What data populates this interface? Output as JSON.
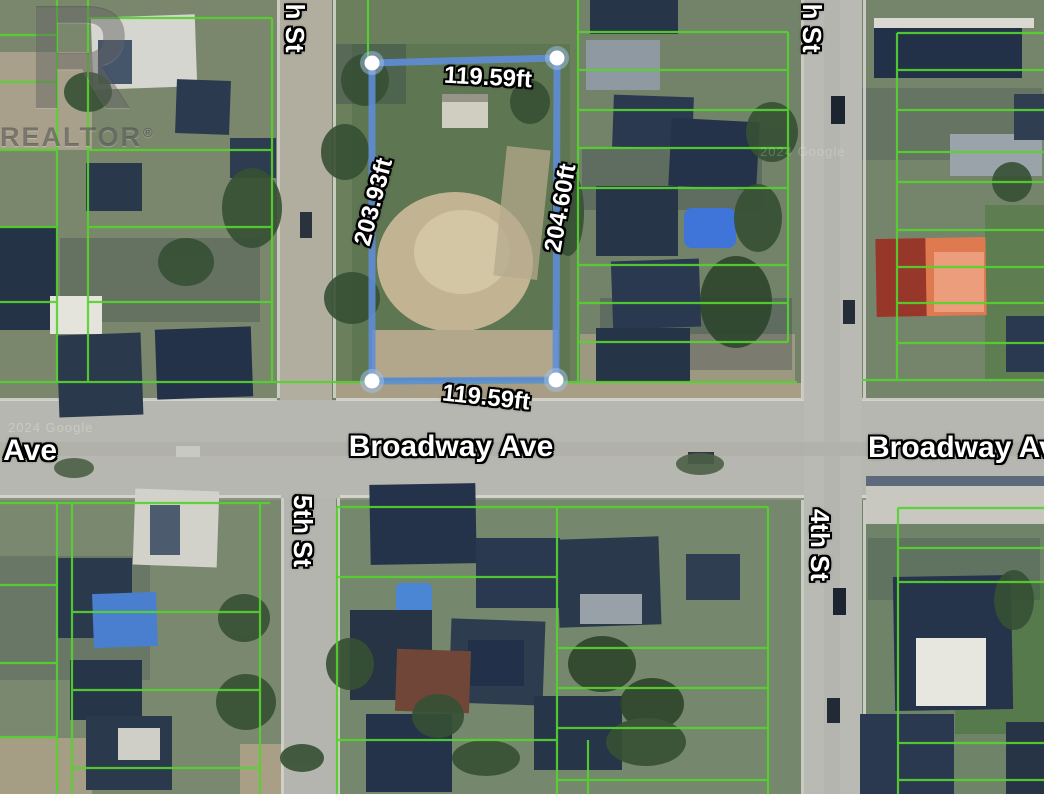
{
  "map": {
    "streets": {
      "fifth_st_partial": "h St",
      "fifth_st": "5th St",
      "fourth_st_partial": "h St",
      "fourth_st": "4th St",
      "broadway_left_partial": "Ave",
      "broadway": "Broadway Ave",
      "broadway_right_partial": "Broadway Av"
    },
    "measurements": {
      "top": "119.59ft",
      "bottom": "119.59ft",
      "left": "203.93ft",
      "right": "204.60ft"
    },
    "watermarks": {
      "realtor_logo_letter": "R",
      "realtor": "REALTOR",
      "registered_symbol": "®",
      "attribution": "2024 Google"
    },
    "colors": {
      "parcel_boundary_blue": "#5e8ed8",
      "parcel_grid_green": "#55d22e",
      "handle_fill": "#ffffff"
    }
  }
}
